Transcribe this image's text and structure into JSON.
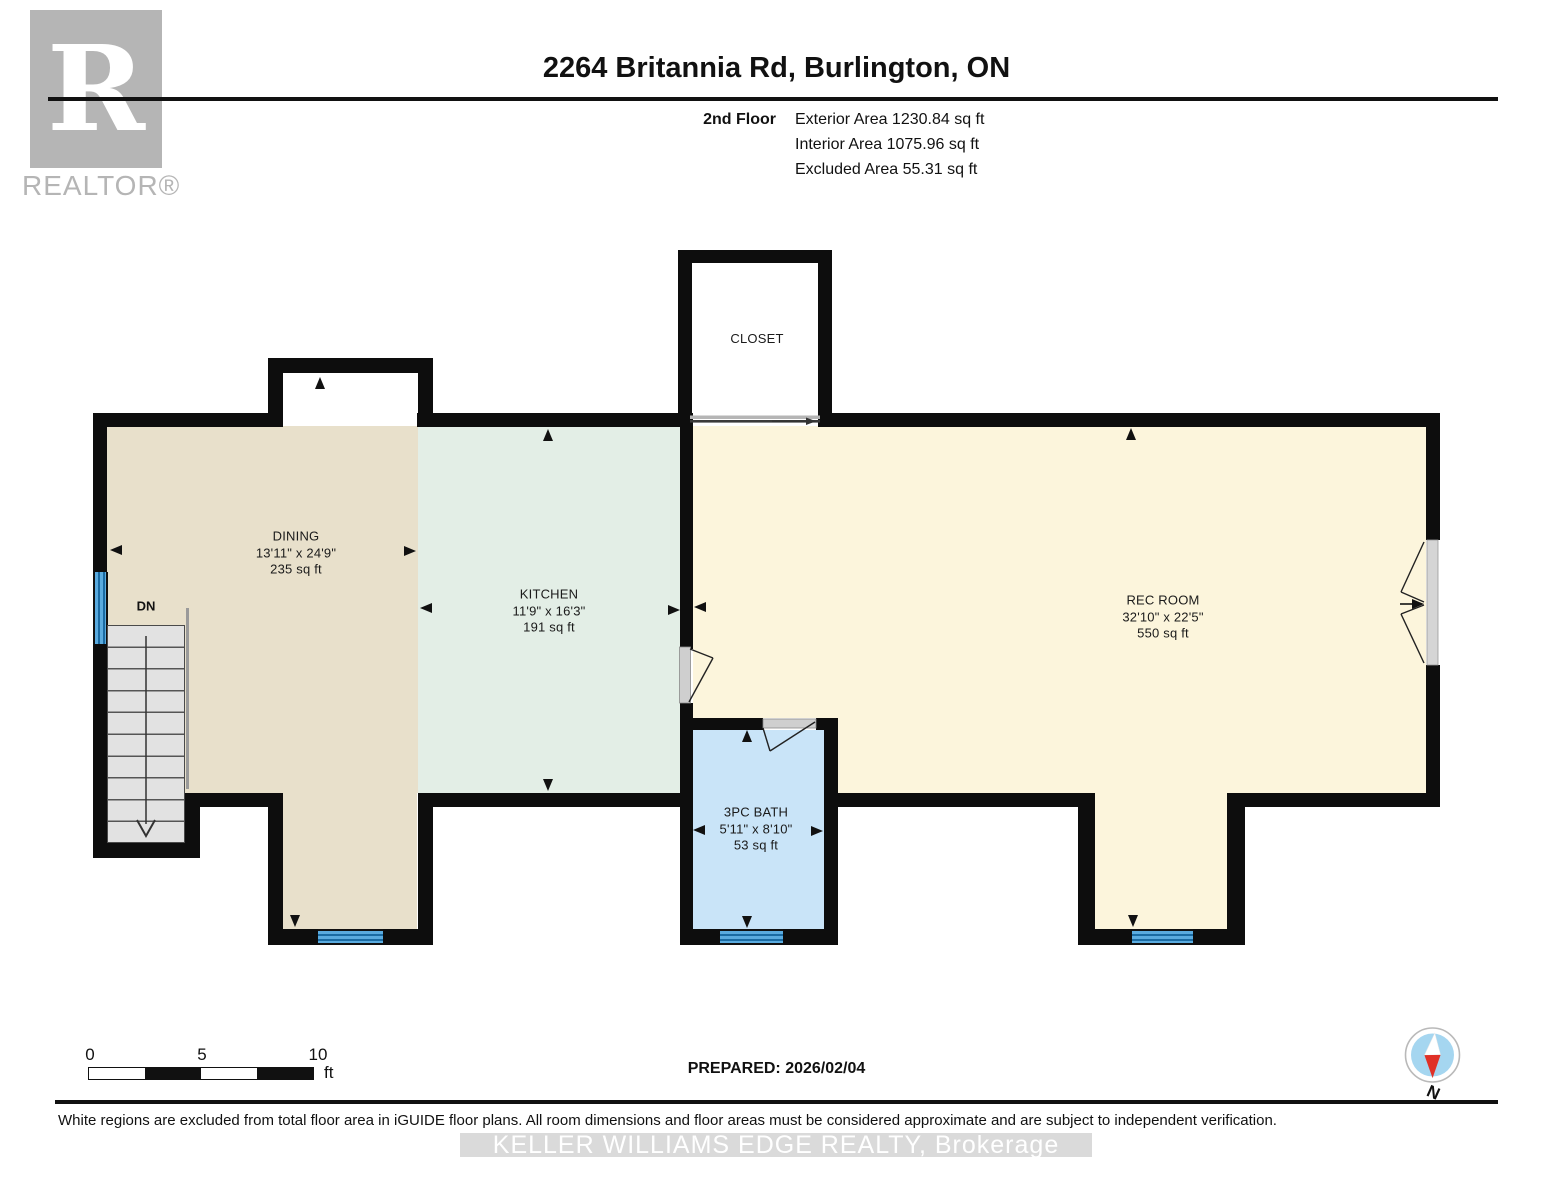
{
  "header": {
    "title": "2264 Britannia Rd, Burlington, ON",
    "floor_label": "2nd Floor",
    "area_lines": [
      "Exterior Area 1230.84 sq ft",
      "Interior Area 1075.96 sq ft",
      "Excluded Area 55.31 sq ft"
    ]
  },
  "logo": {
    "letter": "R",
    "brand": "REALTOR®"
  },
  "rooms": {
    "dining": {
      "name": "DINING",
      "dims": "13'11\" x 24'9\"",
      "area": "235 sq ft"
    },
    "kitchen": {
      "name": "KITCHEN",
      "dims": "11'9\" x 16'3\"",
      "area": "191 sq ft"
    },
    "rec": {
      "name": "REC ROOM",
      "dims": "32'10\" x 22'5\"",
      "area": "550 sq ft"
    },
    "bath": {
      "name": "3PC BATH",
      "dims": "5'11\" x 8'10\"",
      "area": "53 sq ft"
    },
    "closet": {
      "name": "CLOSET"
    }
  },
  "stairs": {
    "label": "DN"
  },
  "scale": {
    "tick0": "0",
    "tick5": "5",
    "tick10": "10",
    "unit": "ft"
  },
  "compass": {
    "north": "N"
  },
  "footer": {
    "prepared": "PREPARED: 2026/02/04",
    "disclaimer": "White regions are excluded from total floor area in iGUIDE floor plans. All room dimensions and floor areas must be considered approximate and are subject to independent verification.",
    "watermark": "KELLER WILLIAMS EDGE REALTY, Brokerage"
  },
  "colors": {
    "wall": "#0d0d0d",
    "dining": "#e8e0cb",
    "kitchen": "#e3eee6",
    "rec_room": "#fcf5dc",
    "bath": "#c9e4f8",
    "window_light": "#5aabdf",
    "window_dark": "#1a6ba3",
    "stairs": "#e2e2e2",
    "door_slab": "#cfcfcf",
    "logo_gray": "#b5b5b5",
    "compass_blue": "#a5d6f0",
    "compass_red": "#e03127",
    "watermark_band": "#dadada"
  }
}
